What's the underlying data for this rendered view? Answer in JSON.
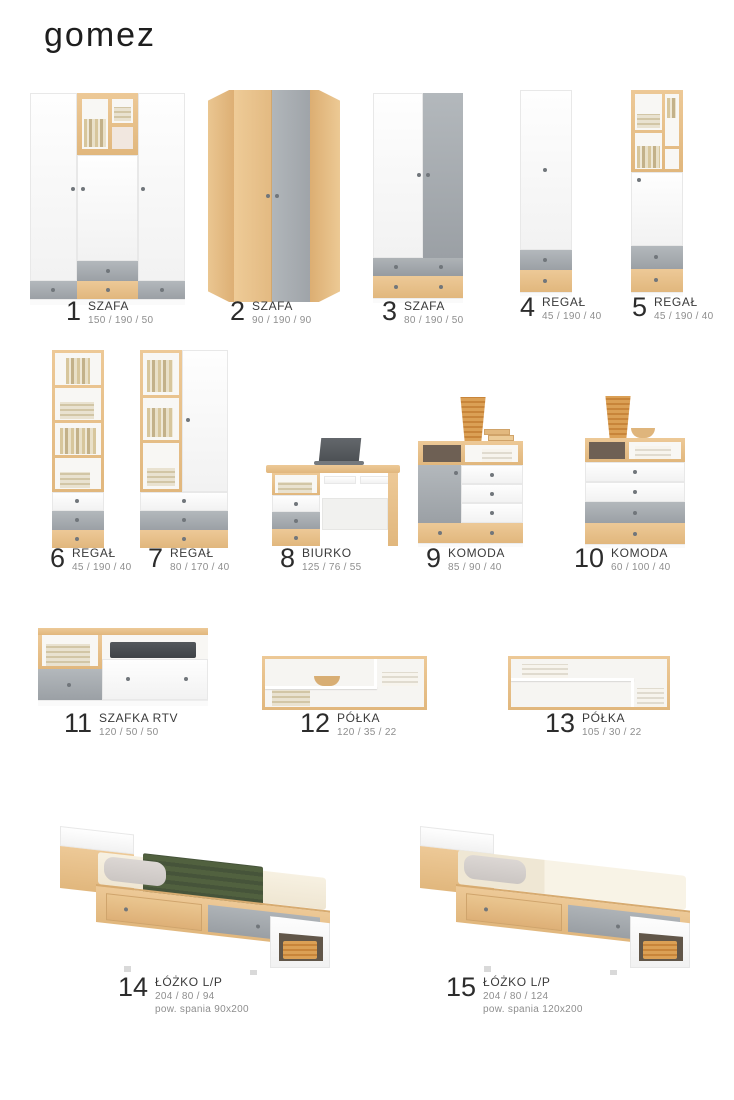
{
  "brand": "gomez",
  "palette": {
    "wood": "#e6c08c",
    "gray": "#a7acb1",
    "white_panel": "#fbfbfb",
    "niche_interior": "#6e6054",
    "blanket_green": "#4b5a3c",
    "pillow_gray": "#d5d0cd",
    "mattress_beige": "#f3ecdb",
    "wicker": "#d89a4b",
    "text_dark": "#2c2c2c",
    "text_muted": "#8e8e8e"
  },
  "products": [
    {
      "num": "1",
      "name": "SZAFA",
      "dims": "150 / 190 / 50"
    },
    {
      "num": "2",
      "name": "SZAFA",
      "dims": "90 / 190 / 90"
    },
    {
      "num": "3",
      "name": "SZAFA",
      "dims": "80 / 190 / 50"
    },
    {
      "num": "4",
      "name": "REGAŁ",
      "dims": "45 / 190 / 40"
    },
    {
      "num": "5",
      "name": "REGAŁ",
      "dims": "45 / 190 / 40"
    },
    {
      "num": "6",
      "name": "REGAŁ",
      "dims": "45 / 190 / 40"
    },
    {
      "num": "7",
      "name": "REGAŁ",
      "dims": "80 / 170 / 40"
    },
    {
      "num": "8",
      "name": "BIURKO",
      "dims": "125 / 76 / 55"
    },
    {
      "num": "9",
      "name": "KOMODA",
      "dims": "85 / 90 / 40"
    },
    {
      "num": "10",
      "name": "KOMODA",
      "dims": "60 / 100 / 40"
    },
    {
      "num": "11",
      "name": "SZAFKA RTV",
      "dims": "120 / 50 / 50"
    },
    {
      "num": "12",
      "name": "PÓŁKA",
      "dims": "120 / 35 / 22"
    },
    {
      "num": "13",
      "name": "PÓŁKA",
      "dims": "105 / 30 / 22"
    },
    {
      "num": "14",
      "name": "ŁÓŻKO L/P",
      "dims": "204 / 80 / 94",
      "extra": "pow. spania 90x200"
    },
    {
      "num": "15",
      "name": "ŁÓŻKO L/P",
      "dims": "204 / 80 / 124",
      "extra": "pow. spania 120x200"
    }
  ]
}
